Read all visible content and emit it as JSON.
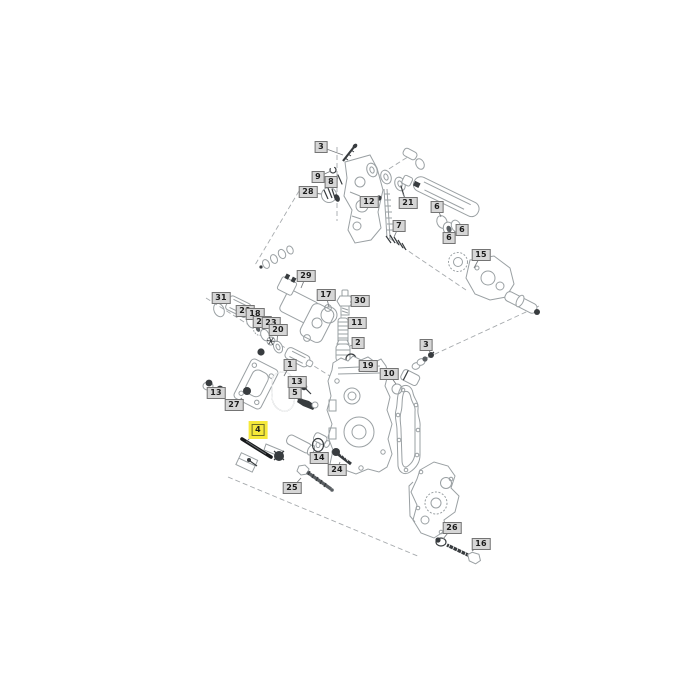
{
  "diagram": {
    "type": "exploded-parts-diagram",
    "colors": {
      "line": "#9aa0a3",
      "mid": "#5a5f63",
      "dark": "#383c3f",
      "label_bg": "#d6d6d6",
      "label_border": "#747474",
      "label_text": "#1c1c1c",
      "highlight": "#f6e93a"
    },
    "highlighted_callout": "4",
    "callouts": [
      {
        "text": "3",
        "x": 321,
        "y": 147,
        "lx": 343,
        "ly": 155,
        "highlighted": false
      },
      {
        "text": "9",
        "x": 318,
        "y": 177,
        "lx": 331,
        "ly": 171,
        "highlighted": false
      },
      {
        "text": "8",
        "x": 331,
        "y": 182,
        "lx": 338,
        "ly": 178,
        "highlighted": false
      },
      {
        "text": "28",
        "x": 308,
        "y": 192,
        "lx": 321,
        "ly": 194,
        "highlighted": false
      },
      {
        "text": "12",
        "x": 369,
        "y": 202,
        "lx": 378,
        "ly": 199,
        "highlighted": false
      },
      {
        "text": "21",
        "x": 408,
        "y": 203,
        "lx": 403,
        "ly": 194,
        "highlighted": false
      },
      {
        "text": "6",
        "x": 437,
        "y": 207,
        "lx": 441,
        "ly": 217,
        "highlighted": false
      },
      {
        "text": "7",
        "x": 399,
        "y": 226,
        "lx": 394,
        "ly": 237,
        "highlighted": false
      },
      {
        "text": "6",
        "x": 462,
        "y": 230,
        "lx": 456,
        "ly": 226,
        "highlighted": false
      },
      {
        "text": "6",
        "x": 449,
        "y": 238,
        "lx": 448,
        "ly": 231,
        "highlighted": false
      },
      {
        "text": "15",
        "x": 481,
        "y": 255,
        "lx": 474,
        "ly": 268,
        "highlighted": false
      },
      {
        "text": "29",
        "x": 306,
        "y": 276,
        "lx": 301,
        "ly": 288,
        "highlighted": false
      },
      {
        "text": "17",
        "x": 326,
        "y": 295,
        "lx": 329,
        "ly": 307,
        "highlighted": false
      },
      {
        "text": "31",
        "x": 221,
        "y": 298,
        "lx": 219,
        "ly": 304,
        "highlighted": false
      },
      {
        "text": "30",
        "x": 360,
        "y": 301,
        "lx": 350,
        "ly": 302,
        "highlighted": false
      },
      {
        "text": "20",
        "x": 245,
        "y": 311,
        "lx": 249,
        "ly": 318,
        "highlighted": false
      },
      {
        "text": "18",
        "x": 255,
        "y": 314,
        "lx": 257,
        "ly": 322,
        "highlighted": false
      },
      {
        "text": "22",
        "x": 262,
        "y": 322,
        "lx": 264,
        "ly": 330,
        "highlighted": false
      },
      {
        "text": "23",
        "x": 271,
        "y": 323,
        "lx": 270,
        "ly": 336,
        "highlighted": false
      },
      {
        "text": "11",
        "x": 357,
        "y": 323,
        "lx": 349,
        "ly": 325,
        "highlighted": false
      },
      {
        "text": "20",
        "x": 278,
        "y": 330,
        "lx": 277,
        "ly": 342,
        "highlighted": false
      },
      {
        "text": "2",
        "x": 358,
        "y": 343,
        "lx": 350,
        "ly": 346,
        "highlighted": false
      },
      {
        "text": "3",
        "x": 426,
        "y": 345,
        "lx": 430,
        "ly": 352,
        "highlighted": false
      },
      {
        "text": "1",
        "x": 290,
        "y": 365,
        "lx": 284,
        "ly": 376,
        "highlighted": false
      },
      {
        "text": "19",
        "x": 368,
        "y": 366,
        "lx": 358,
        "ly": 370,
        "highlighted": false
      },
      {
        "text": "10",
        "x": 389,
        "y": 374,
        "lx": 396,
        "ly": 384,
        "highlighted": false
      },
      {
        "text": "13",
        "x": 297,
        "y": 382,
        "lx": 303,
        "ly": 385,
        "highlighted": false
      },
      {
        "text": "13",
        "x": 216,
        "y": 393,
        "lx": 212,
        "ly": 388,
        "highlighted": false
      },
      {
        "text": "5",
        "x": 295,
        "y": 393,
        "lx": 302,
        "ly": 399,
        "highlighted": false
      },
      {
        "text": "27",
        "x": 234,
        "y": 405,
        "lx": 242,
        "ly": 398,
        "highlighted": false
      },
      {
        "text": "4",
        "x": 258,
        "y": 430,
        "lx": 248,
        "ly": 440,
        "highlighted": true
      },
      {
        "text": "14",
        "x": 319,
        "y": 458,
        "lx": 318,
        "ly": 451,
        "highlighted": false
      },
      {
        "text": "24",
        "x": 337,
        "y": 470,
        "lx": 340,
        "ly": 462,
        "highlighted": false
      },
      {
        "text": "25",
        "x": 292,
        "y": 488,
        "lx": 301,
        "ly": 478,
        "highlighted": false
      },
      {
        "text": "26",
        "x": 452,
        "y": 528,
        "lx": 443,
        "ly": 539,
        "highlighted": false
      },
      {
        "text": "16",
        "x": 481,
        "y": 544,
        "lx": 472,
        "ly": 551,
        "highlighted": false
      }
    ]
  }
}
